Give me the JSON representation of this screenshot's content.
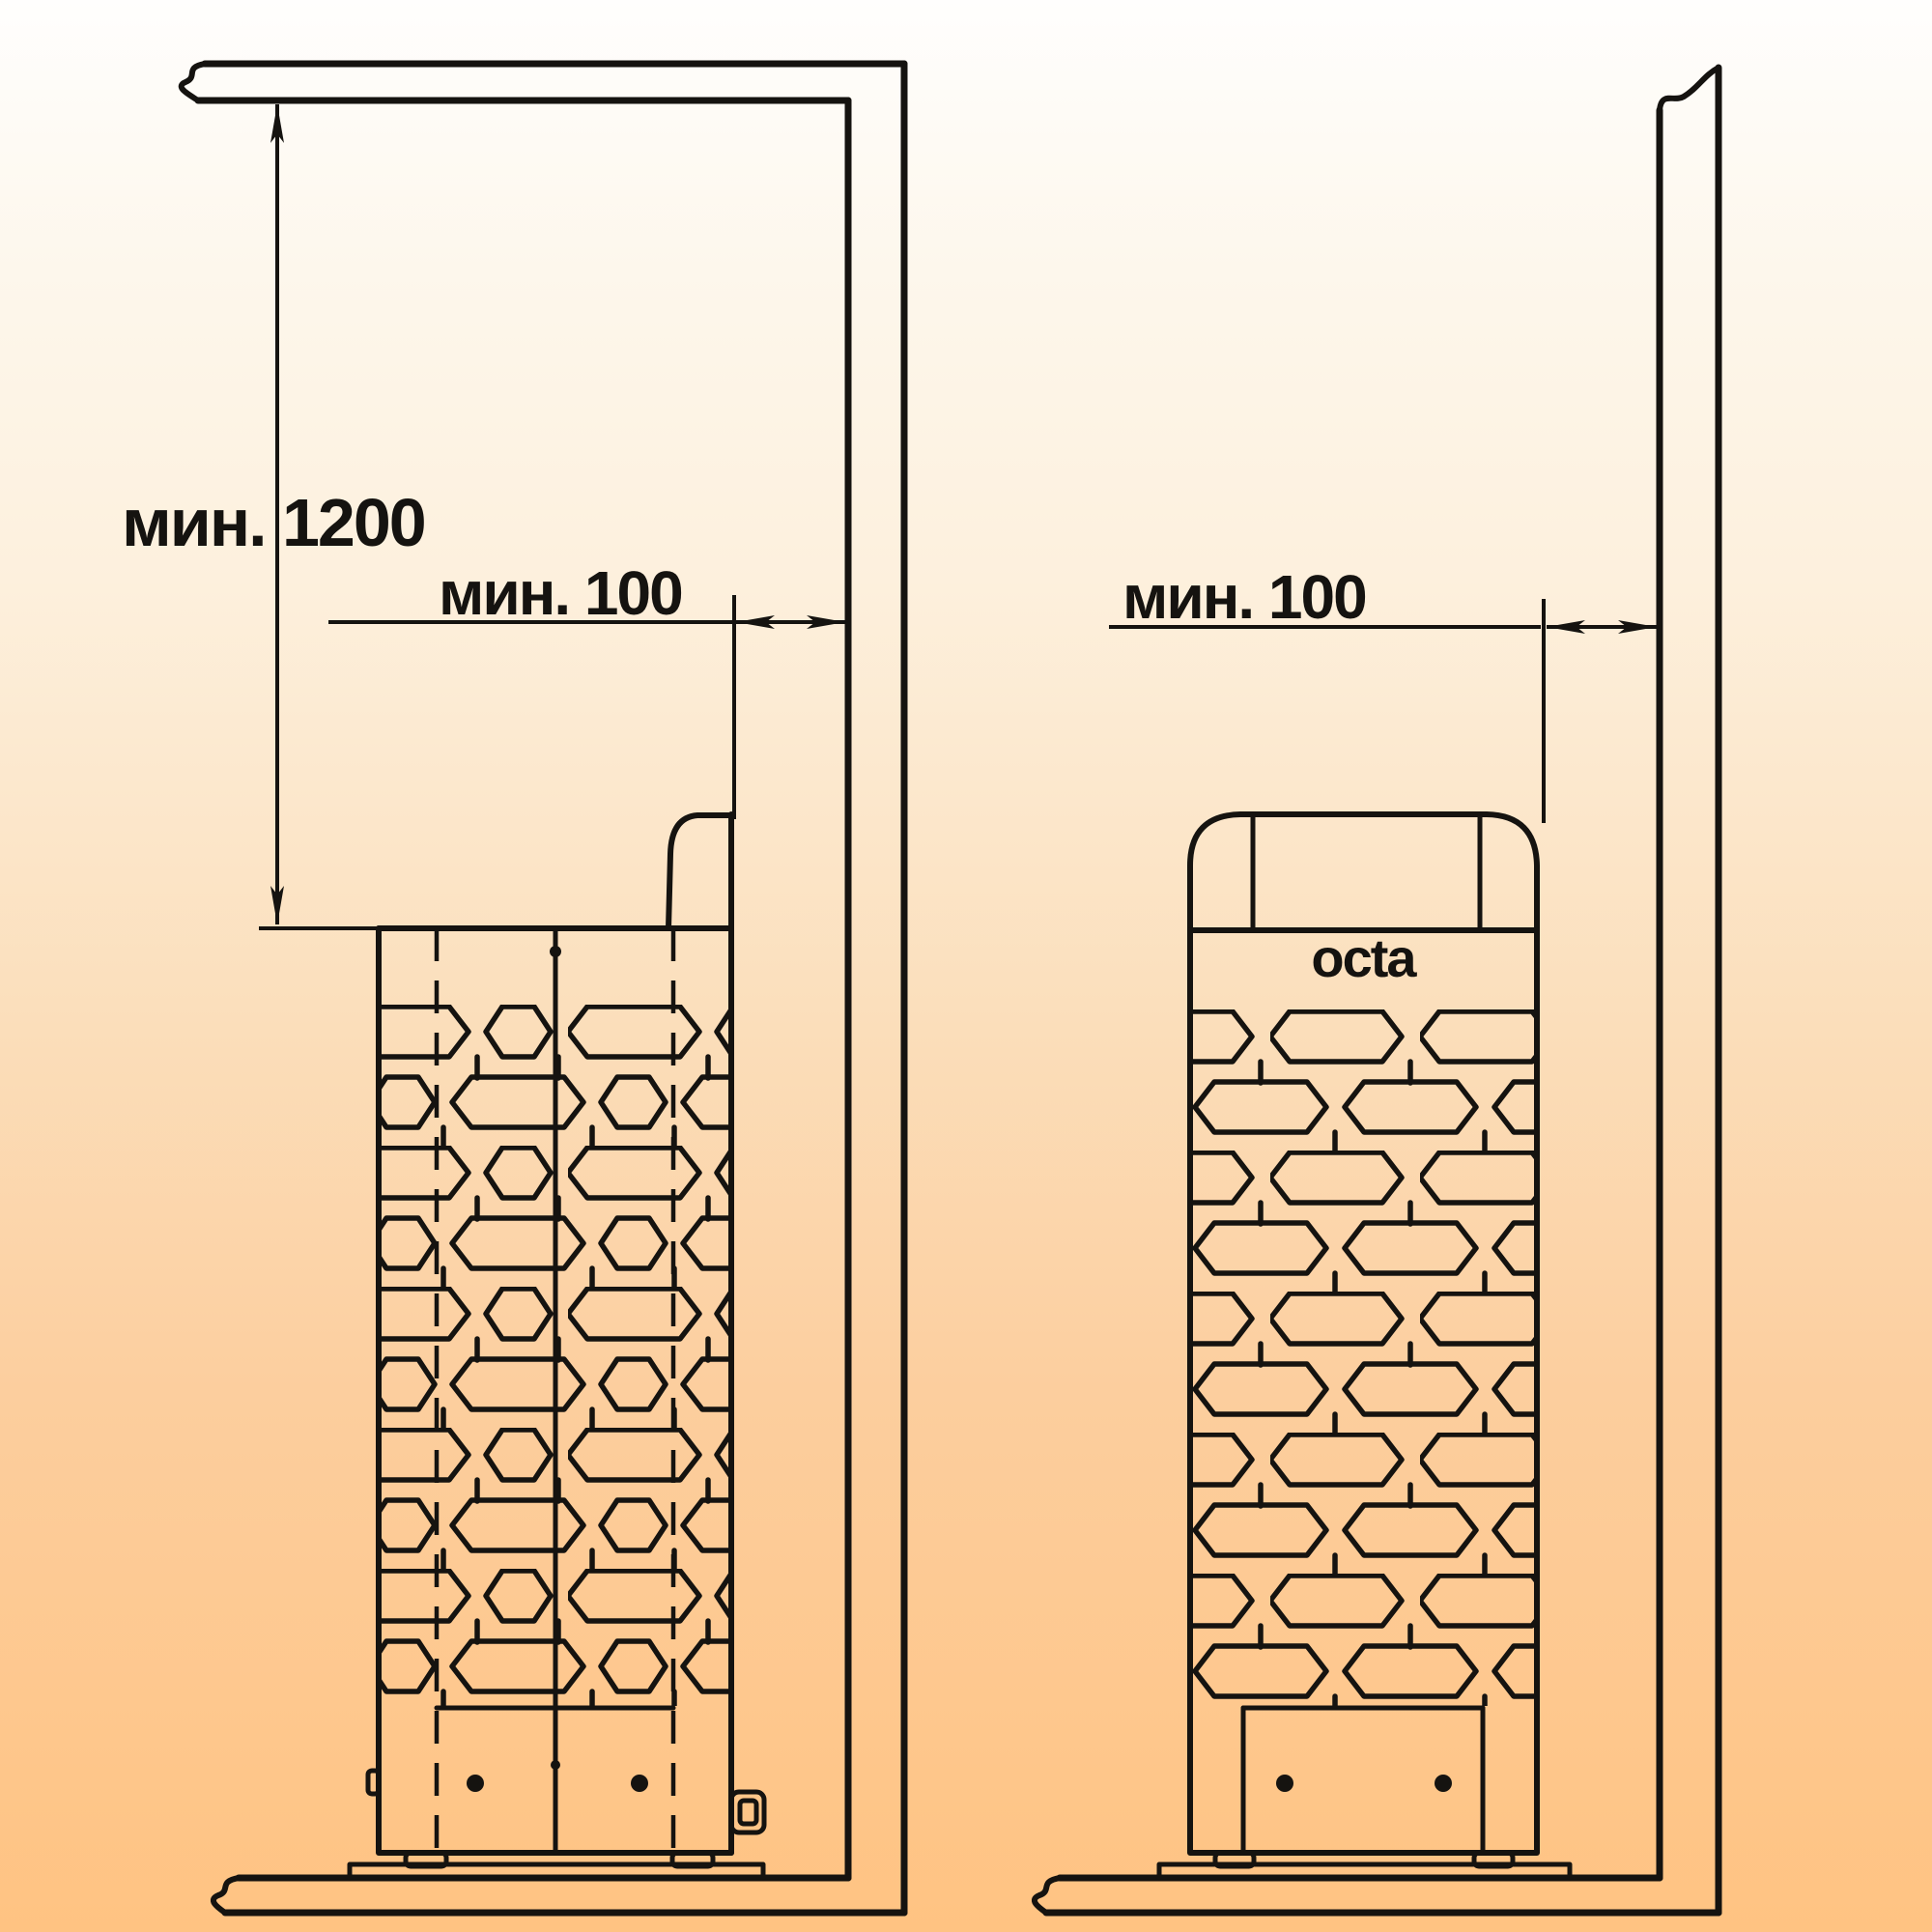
{
  "colors": {
    "line": "#151310",
    "text": "#151310",
    "background_top": "#fffefd",
    "background_bottom": "#ffc382"
  },
  "left_view": {
    "vertical_clearance_label": "мин. 1200",
    "wall_clearance_label": "мин. 100"
  },
  "right_view": {
    "wall_clearance_label": "мин. 100",
    "logo_text": "octa"
  }
}
